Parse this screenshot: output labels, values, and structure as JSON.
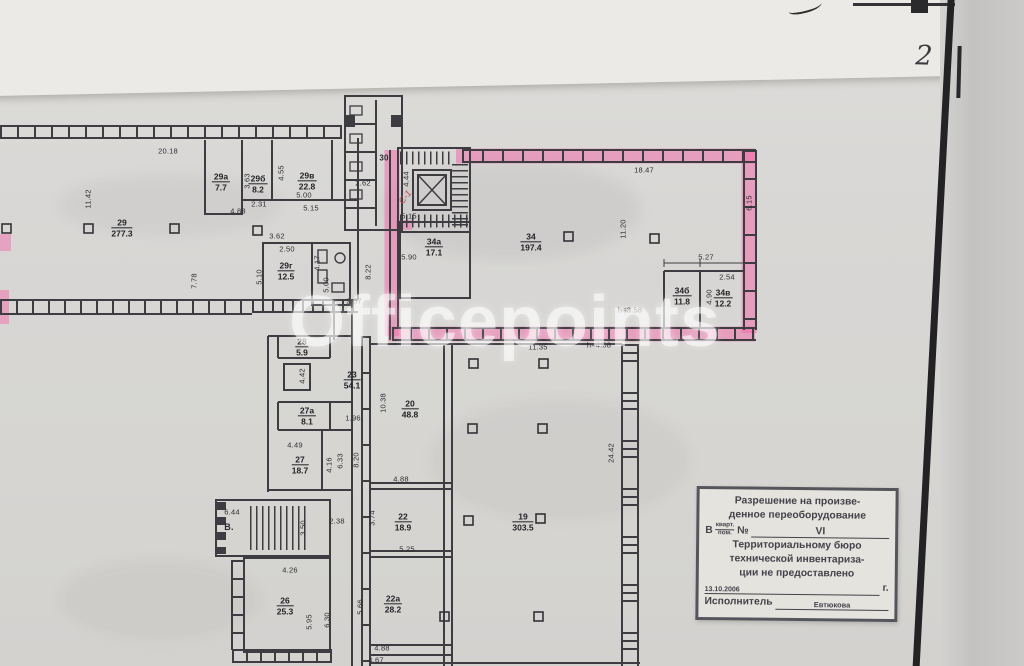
{
  "page_number": "2",
  "watermark": "Officepoints",
  "plan": {
    "unit_note": "С-1",
    "wc_room": "30",
    "stair_label": "В.",
    "rooms": [
      {
        "number": "29",
        "area": "277.3"
      },
      {
        "number": "29а",
        "area": "7.7"
      },
      {
        "number": "29б",
        "area": "8.2"
      },
      {
        "number": "29в",
        "area": "22.8"
      },
      {
        "number": "29г",
        "area": "12.5"
      },
      {
        "number": "34а",
        "area": "17.1"
      },
      {
        "number": "34",
        "area": "197.4"
      },
      {
        "number": "34б",
        "area": "11.8"
      },
      {
        "number": "34в",
        "area": "12.2"
      },
      {
        "number": "28",
        "area": "5.9"
      },
      {
        "number": "23",
        "area": "54.1"
      },
      {
        "number": "27а",
        "area": "8.1"
      },
      {
        "number": "27",
        "area": "18.7"
      },
      {
        "number": "20",
        "area": "48.8"
      },
      {
        "number": "22",
        "area": "18.9"
      },
      {
        "number": "22а",
        "area": "28.2"
      },
      {
        "number": "26",
        "area": "25.3"
      },
      {
        "number": "19",
        "area": "303.5"
      }
    ],
    "dims": [
      "20.18",
      "11.42",
      "7.78",
      "3.63",
      "2.31",
      "4.83",
      "4.55",
      "5.00",
      "5.15",
      "3.62",
      "2.50",
      "5.10",
      "4.17",
      "5.00",
      "2.62",
      "4.44",
      "5.15",
      "2.57",
      "8.22",
      "18.47",
      "6.15",
      "11.20",
      "5.90",
      "5.27",
      "2.54",
      "4.90",
      "11.35",
      "10.38",
      "1.96",
      "4.42",
      "4.49",
      "4.16",
      "6.33",
      "8.20",
      "4.88",
      "24.42",
      "3.74",
      "5.25",
      "2.38",
      "3.50",
      "6.44",
      "4.26",
      "5.95",
      "6.30",
      "5.66",
      "4.88",
      "4.67"
    ],
    "heights": [
      "h=3.58",
      "h=4.08"
    ]
  },
  "stamp": {
    "title_line1": "Разрешение на произве-",
    "title_line2": "денное переоборудование",
    "in_label": "В",
    "frac_top": "кварт.",
    "frac_bottom": "пом.",
    "number_sign": "№",
    "unit_value": "VI",
    "body_line1": "Территориальному бюро",
    "body_line2": "технической инвентариза-",
    "body_line3": "ции не предоставлено",
    "date": "13.10.2006",
    "year_suffix": "г.",
    "executor_label": "Исполнитель",
    "executor_name": "Евтюкова"
  }
}
